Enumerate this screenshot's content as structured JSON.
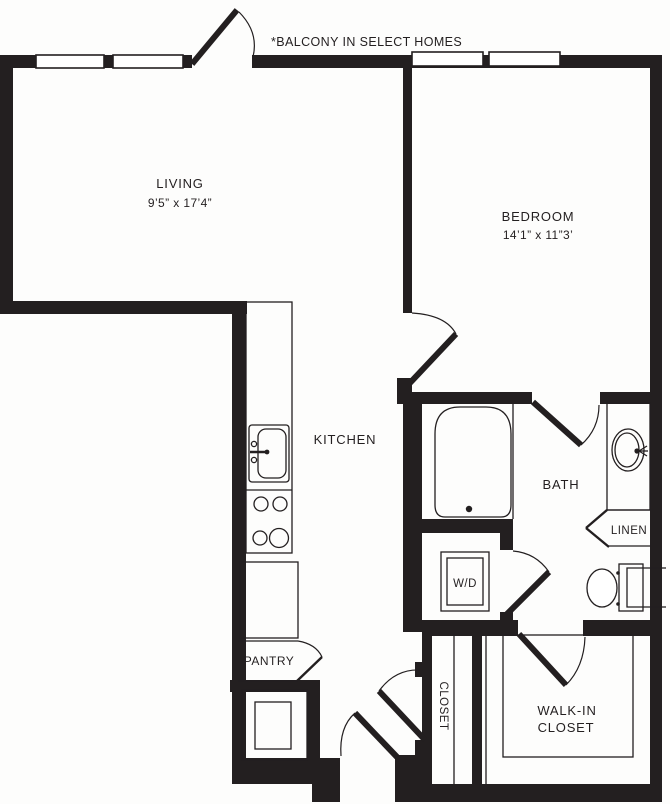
{
  "note": "*BALCONY IN SELECT HOMES",
  "colors": {
    "wall": "#231f20",
    "background": "#ffffff",
    "text": "#231f20"
  },
  "rooms": {
    "living": {
      "label": "LIVING",
      "dimensions": "9’5” x 17’4”"
    },
    "bedroom": {
      "label": "BEDROOM",
      "dimensions": "14’1” x 11”3’"
    },
    "kitchen": {
      "label": "KITCHEN"
    },
    "bath": {
      "label": "BATH"
    },
    "linen": {
      "label": "LINEN"
    },
    "washer_dryer": {
      "label": "W/D"
    },
    "pantry": {
      "label": "PANTRY"
    },
    "closet": {
      "label": "CLOSET"
    },
    "walk_in_closet": {
      "label_line1": "WALK-IN",
      "label_line2": "CLOSET"
    }
  }
}
